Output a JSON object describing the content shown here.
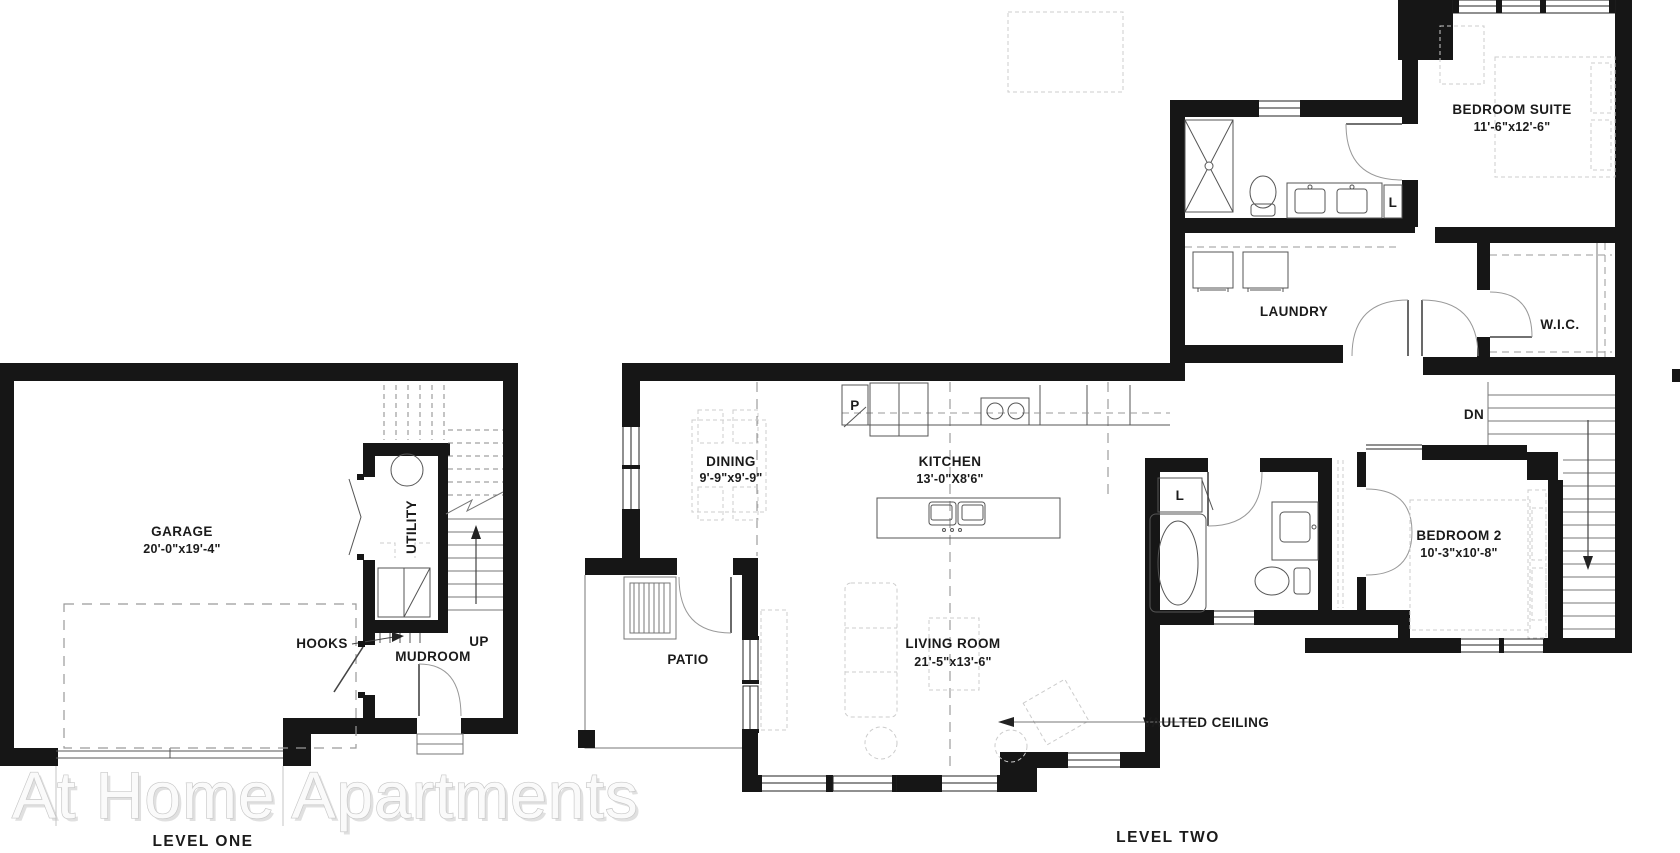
{
  "watermark": {
    "text": "At Home Apartments"
  },
  "colors": {
    "background": "#ffffff",
    "wall": "#161616",
    "fixture_line": "#555555",
    "furniture_dash": "#cccccc",
    "watermark_fill": "#fafafa",
    "watermark_outline": "#c6c6c6",
    "label_text": "#1b1b1b"
  },
  "levels": {
    "one": {
      "title": "LEVEL ONE",
      "labels": {
        "garage_name": "GARAGE",
        "garage_dims": "20'-0\"x19'-4\"",
        "utility": "UTILITY",
        "hooks": "HOOKS",
        "mudroom": "MUDROOM",
        "up": "UP"
      }
    },
    "two": {
      "title": "LEVEL TWO",
      "labels": {
        "bedroom_suite_name": "BEDROOM SUITE",
        "bedroom_suite_dims": "11'-6\"x12'-6\"",
        "laundry": "LAUNDRY",
        "wic": "W.I.C.",
        "dn": "DN",
        "linen_bath1": "L",
        "linen_bath2": "L",
        "pantry": "P",
        "dining_name": "DINING",
        "dining_dims": "9'-9\"x9'-9\"",
        "kitchen_name": "KITCHEN",
        "kitchen_dims": "13'-0\"X8'6\"",
        "patio": "PATIO",
        "living_room_name": "LIVING ROOM",
        "living_room_dims": "21'-5\"x13'-6\"",
        "bedroom2_name": "BEDROOM 2",
        "bedroom2_dims": "10'-3\"x10'-8\"",
        "vaulted_ceiling": "VAULTED CEILING"
      }
    }
  }
}
